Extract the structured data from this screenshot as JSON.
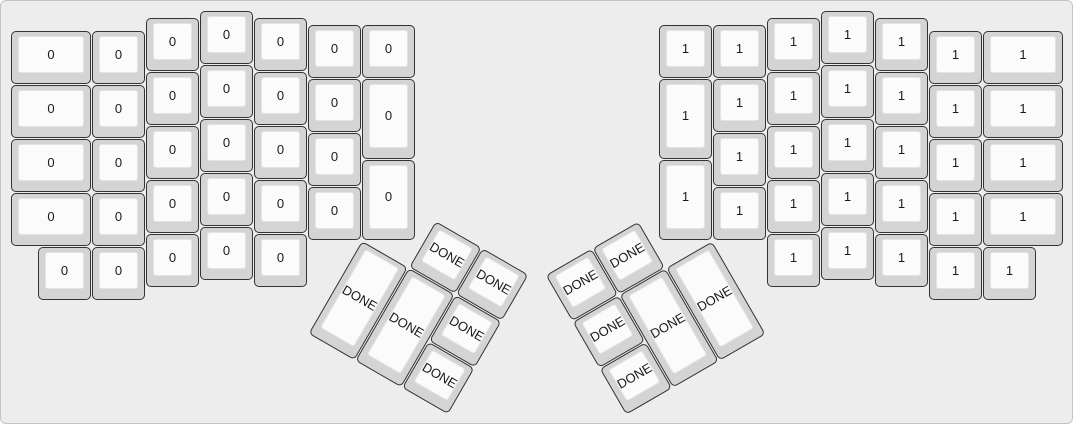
{
  "app": {
    "description": "ErgoDox keyboard layout render",
    "canvas_bg": "#ededed",
    "canvas_border": "#c4c4c4"
  },
  "key_style": {
    "cap_base_color": "#d4d4d4",
    "cap_border_color": "#333333",
    "cap_top_color": "#fbfbfb",
    "cap_top_border_color": "#e4e4e4",
    "label_color": "#1a1a1a"
  },
  "keyboard": {
    "unit_px": 54,
    "padding_px": 10,
    "groups": [
      {
        "name": "left-main",
        "rotation_deg": 0,
        "origin_u": [
          0,
          0
        ],
        "keys": [
          {
            "x": 0,
            "y": 0.375,
            "w": 1.5,
            "h": 1,
            "label": "0"
          },
          {
            "x": 0,
            "y": 1.375,
            "w": 1.5,
            "h": 1,
            "label": "0"
          },
          {
            "x": 0,
            "y": 2.375,
            "w": 1.5,
            "h": 1,
            "label": "0"
          },
          {
            "x": 0,
            "y": 3.375,
            "w": 1.5,
            "h": 1,
            "label": "0"
          },
          {
            "x": 0.5,
            "y": 4.375,
            "w": 1,
            "h": 1,
            "label": "0"
          },
          {
            "x": 1.5,
            "y": 0.375,
            "w": 1,
            "h": 1,
            "label": "0"
          },
          {
            "x": 1.5,
            "y": 1.375,
            "w": 1,
            "h": 1,
            "label": "0"
          },
          {
            "x": 1.5,
            "y": 2.375,
            "w": 1,
            "h": 1,
            "label": "0"
          },
          {
            "x": 1.5,
            "y": 3.375,
            "w": 1,
            "h": 1,
            "label": "0"
          },
          {
            "x": 1.5,
            "y": 4.375,
            "w": 1,
            "h": 1,
            "label": "0"
          },
          {
            "x": 2.5,
            "y": 0.125,
            "w": 1,
            "h": 1,
            "label": "0"
          },
          {
            "x": 2.5,
            "y": 1.125,
            "w": 1,
            "h": 1,
            "label": "0"
          },
          {
            "x": 2.5,
            "y": 2.125,
            "w": 1,
            "h": 1,
            "label": "0"
          },
          {
            "x": 2.5,
            "y": 3.125,
            "w": 1,
            "h": 1,
            "label": "0"
          },
          {
            "x": 2.5,
            "y": 4.125,
            "w": 1,
            "h": 1,
            "label": "0"
          },
          {
            "x": 3.5,
            "y": 0,
            "w": 1,
            "h": 1,
            "label": "0"
          },
          {
            "x": 3.5,
            "y": 1,
            "w": 1,
            "h": 1,
            "label": "0"
          },
          {
            "x": 3.5,
            "y": 2,
            "w": 1,
            "h": 1,
            "label": "0"
          },
          {
            "x": 3.5,
            "y": 3,
            "w": 1,
            "h": 1,
            "label": "0"
          },
          {
            "x": 3.5,
            "y": 4,
            "w": 1,
            "h": 1,
            "label": "0"
          },
          {
            "x": 4.5,
            "y": 0.125,
            "w": 1,
            "h": 1,
            "label": "0"
          },
          {
            "x": 4.5,
            "y": 1.125,
            "w": 1,
            "h": 1,
            "label": "0"
          },
          {
            "x": 4.5,
            "y": 2.125,
            "w": 1,
            "h": 1,
            "label": "0"
          },
          {
            "x": 4.5,
            "y": 3.125,
            "w": 1,
            "h": 1,
            "label": "0"
          },
          {
            "x": 4.5,
            "y": 4.125,
            "w": 1,
            "h": 1,
            "label": "0"
          },
          {
            "x": 5.5,
            "y": 0.25,
            "w": 1,
            "h": 1,
            "label": "0"
          },
          {
            "x": 5.5,
            "y": 1.25,
            "w": 1,
            "h": 1,
            "label": "0"
          },
          {
            "x": 5.5,
            "y": 2.25,
            "w": 1,
            "h": 1,
            "label": "0"
          },
          {
            "x": 5.5,
            "y": 3.25,
            "w": 1,
            "h": 1,
            "label": "0"
          },
          {
            "x": 6.5,
            "y": 0.25,
            "w": 1,
            "h": 1,
            "label": "0"
          },
          {
            "x": 6.5,
            "y": 1.25,
            "w": 1,
            "h": 1.5,
            "label": "0"
          },
          {
            "x": 6.5,
            "y": 2.75,
            "w": 1,
            "h": 1.5,
            "label": "0"
          }
        ]
      },
      {
        "name": "right-main",
        "rotation_deg": 0,
        "origin_u": [
          0,
          0
        ],
        "keys": [
          {
            "x": 12,
            "y": 0.25,
            "w": 1,
            "h": 1,
            "label": "1"
          },
          {
            "x": 12,
            "y": 1.25,
            "w": 1,
            "h": 1.5,
            "label": "1"
          },
          {
            "x": 12,
            "y": 2.75,
            "w": 1,
            "h": 1.5,
            "label": "1"
          },
          {
            "x": 13,
            "y": 0.25,
            "w": 1,
            "h": 1,
            "label": "1"
          },
          {
            "x": 13,
            "y": 1.25,
            "w": 1,
            "h": 1,
            "label": "1"
          },
          {
            "x": 13,
            "y": 2.25,
            "w": 1,
            "h": 1,
            "label": "1"
          },
          {
            "x": 13,
            "y": 3.25,
            "w": 1,
            "h": 1,
            "label": "1"
          },
          {
            "x": 14,
            "y": 0.125,
            "w": 1,
            "h": 1,
            "label": "1"
          },
          {
            "x": 14,
            "y": 1.125,
            "w": 1,
            "h": 1,
            "label": "1"
          },
          {
            "x": 14,
            "y": 2.125,
            "w": 1,
            "h": 1,
            "label": "1"
          },
          {
            "x": 14,
            "y": 3.125,
            "w": 1,
            "h": 1,
            "label": "1"
          },
          {
            "x": 14,
            "y": 4.125,
            "w": 1,
            "h": 1,
            "label": "1"
          },
          {
            "x": 15,
            "y": 0,
            "w": 1,
            "h": 1,
            "label": "1"
          },
          {
            "x": 15,
            "y": 1,
            "w": 1,
            "h": 1,
            "label": "1"
          },
          {
            "x": 15,
            "y": 2,
            "w": 1,
            "h": 1,
            "label": "1"
          },
          {
            "x": 15,
            "y": 3,
            "w": 1,
            "h": 1,
            "label": "1"
          },
          {
            "x": 15,
            "y": 4,
            "w": 1,
            "h": 1,
            "label": "1"
          },
          {
            "x": 16,
            "y": 0.125,
            "w": 1,
            "h": 1,
            "label": "1"
          },
          {
            "x": 16,
            "y": 1.125,
            "w": 1,
            "h": 1,
            "label": "1"
          },
          {
            "x": 16,
            "y": 2.125,
            "w": 1,
            "h": 1,
            "label": "1"
          },
          {
            "x": 16,
            "y": 3.125,
            "w": 1,
            "h": 1,
            "label": "1"
          },
          {
            "x": 16,
            "y": 4.125,
            "w": 1,
            "h": 1,
            "label": "1"
          },
          {
            "x": 17,
            "y": 0.375,
            "w": 1,
            "h": 1,
            "label": "1"
          },
          {
            "x": 17,
            "y": 1.375,
            "w": 1,
            "h": 1,
            "label": "1"
          },
          {
            "x": 17,
            "y": 2.375,
            "w": 1,
            "h": 1,
            "label": "1"
          },
          {
            "x": 17,
            "y": 3.375,
            "w": 1,
            "h": 1,
            "label": "1"
          },
          {
            "x": 17,
            "y": 4.375,
            "w": 1,
            "h": 1,
            "label": "1"
          },
          {
            "x": 18,
            "y": 0.375,
            "w": 1.5,
            "h": 1,
            "label": "1"
          },
          {
            "x": 18,
            "y": 1.375,
            "w": 1.5,
            "h": 1,
            "label": "1"
          },
          {
            "x": 18,
            "y": 2.375,
            "w": 1.5,
            "h": 1,
            "label": "1"
          },
          {
            "x": 18,
            "y": 3.375,
            "w": 1.5,
            "h": 1,
            "label": "1"
          },
          {
            "x": 18,
            "y": 4.375,
            "w": 1,
            "h": 1,
            "label": "1"
          }
        ]
      },
      {
        "name": "left-thumb-cluster",
        "rotation_deg": 30,
        "origin_u": [
          6.5,
          4.25
        ],
        "keys": [
          {
            "x": 1,
            "y": -1,
            "w": 1,
            "h": 1,
            "label": "DONE"
          },
          {
            "x": 2,
            "y": -1,
            "w": 1,
            "h": 1,
            "label": "DONE"
          },
          {
            "x": 0,
            "y": 0,
            "w": 1,
            "h": 2,
            "label": "DONE"
          },
          {
            "x": 1,
            "y": 0,
            "w": 1,
            "h": 2,
            "label": "DONE"
          },
          {
            "x": 2,
            "y": 0,
            "w": 1,
            "h": 1,
            "label": "DONE"
          },
          {
            "x": 2,
            "y": 1,
            "w": 1,
            "h": 1,
            "label": "DONE"
          }
        ]
      },
      {
        "name": "right-thumb-cluster",
        "rotation_deg": -30,
        "origin_u": [
          13,
          4.25
        ],
        "keys": [
          {
            "x": -3,
            "y": -1,
            "w": 1,
            "h": 1,
            "label": "DONE"
          },
          {
            "x": -2,
            "y": -1,
            "w": 1,
            "h": 1,
            "label": "DONE"
          },
          {
            "x": -3,
            "y": 0,
            "w": 1,
            "h": 1,
            "label": "DONE"
          },
          {
            "x": -2,
            "y": 0,
            "w": 1,
            "h": 2,
            "label": "DONE"
          },
          {
            "x": -1,
            "y": 0,
            "w": 1,
            "h": 2,
            "label": "DONE"
          },
          {
            "x": -3,
            "y": 1,
            "w": 1,
            "h": 1,
            "label": "DONE"
          }
        ]
      }
    ]
  }
}
